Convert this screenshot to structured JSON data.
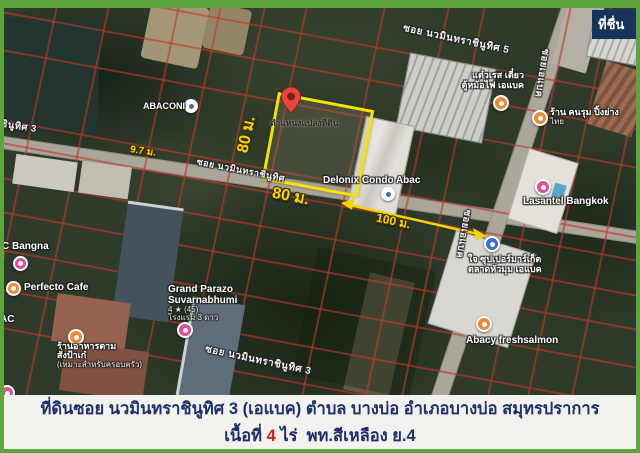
{
  "frame": {
    "border_color": "#5ca43c",
    "caption_bg": "#f4f2ee",
    "caption_text": "#1e2f6d",
    "caption_red": "#d01d15"
  },
  "watermark": {
    "label": "ที่ชื่น"
  },
  "plot": {
    "outline_color": "#f7e200",
    "marker_label": "ตำแหน่งแปลงที่ดิน",
    "side_left": "80 ม.",
    "side_bottom": "80 ม.",
    "road_width": "9.7 ม.",
    "frontage": "100 ม."
  },
  "streets": {
    "navamin3_top": "ซอย นวมินทราชินูทิศ 3",
    "navamin5": "ซอย นวมินทราชินูทิศ 5",
    "navamin_mid": "ซอย นวมินทราชินูทิศ",
    "navamin3_bottom": "ซอย นวมินทราชินูทิศ 3",
    "abac_top": "ซอยเอแบค",
    "abac_mid": "ซอยเอแบค"
  },
  "pois": {
    "abacondo": {
      "label": "ABACONI"
    },
    "delonix": {
      "label": "Delonix Condo Abac"
    },
    "abac_bangna": {
      "label": "C Bangna"
    },
    "perfecto": {
      "label": "Perfecto Cafe"
    },
    "ac_partial": {
      "label": "AC"
    },
    "tamsang": {
      "line1": "ร้านอาหารตาม",
      "line2": "สั่งป้าเก๋",
      "line3": "(เหมาะสำหรับครอบครัว)"
    },
    "grand_parazo": {
      "line1": "Grand Parazo",
      "line2": "Suvarnabhumi",
      "rating": "4 ★ (45)",
      "type": "โรงแรม 3 ดาว"
    },
    "khonrum": {
      "line1": "ร้าน คนรุม ปิ้งย่าง",
      "line2": "ไทย"
    },
    "taew": {
      "line1": "แต๋วเรส เตี๋ยว",
      "line2": "ตู้หม้อไฟ เอแบค"
    },
    "supermarket": {
      "line1": "ใจ ซุปเปอร์มาร์เก็ต",
      "line2": "ตลาดหัวมุม เอแบค"
    },
    "freshsalmon": {
      "label": "Abacy freshsalmon"
    },
    "lasantel": {
      "label": "Lasantel Bangkok"
    }
  },
  "caption": {
    "line1": "ที่ดินซอย นวมินทราชินูทิศ 3 (เอแบค) ตำบล บางบ่อ อำเภอบางบ่อ สมุทรปราการ",
    "line2_prefix": "เนื้อที่ ",
    "line2_area": "4",
    "line2_suffix": " ไร่  พท.สีเหลือง ย.4"
  }
}
